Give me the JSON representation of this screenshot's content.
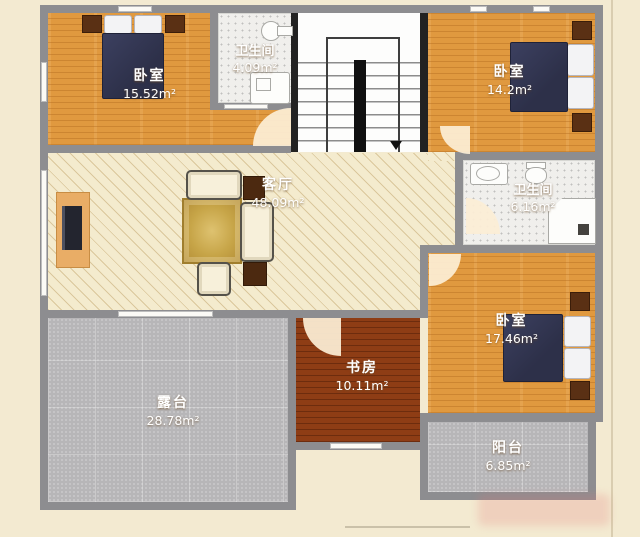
{
  "plan_title": "residential-floor-plan",
  "rooms": {
    "bedroom_top_left": {
      "name": "卧室",
      "area": "15.52m²"
    },
    "bathroom_top": {
      "name": "卫生间",
      "area": "4.09m²"
    },
    "bedroom_top_right": {
      "name": "卧室",
      "area": "14.2m²"
    },
    "living_room": {
      "name": "客厅",
      "area": "48.09m²"
    },
    "bathroom_right": {
      "name": "卫生间",
      "area": "6.16m²"
    },
    "bedroom_bottom_right": {
      "name": "卧室",
      "area": "17.46m²"
    },
    "study": {
      "name": "书房",
      "area": "10.11m²"
    },
    "terrace": {
      "name": "露台",
      "area": "28.78m²"
    },
    "balcony": {
      "name": "阳台",
      "area": "6.85m²"
    }
  },
  "colors": {
    "wall": "#8d8d90",
    "stair_wall": "#222222",
    "wood_floor": "#e0993f",
    "study_floor": "#8e3d15",
    "living_floor": "#f4ebce",
    "terrace_floor": "#b7b6b8",
    "bathroom_floor": "#f0efec",
    "bed": "#2d3049",
    "dark_furniture": "#5a3014",
    "paper": "#f3ead1"
  },
  "stairs": {
    "direction": "down"
  }
}
